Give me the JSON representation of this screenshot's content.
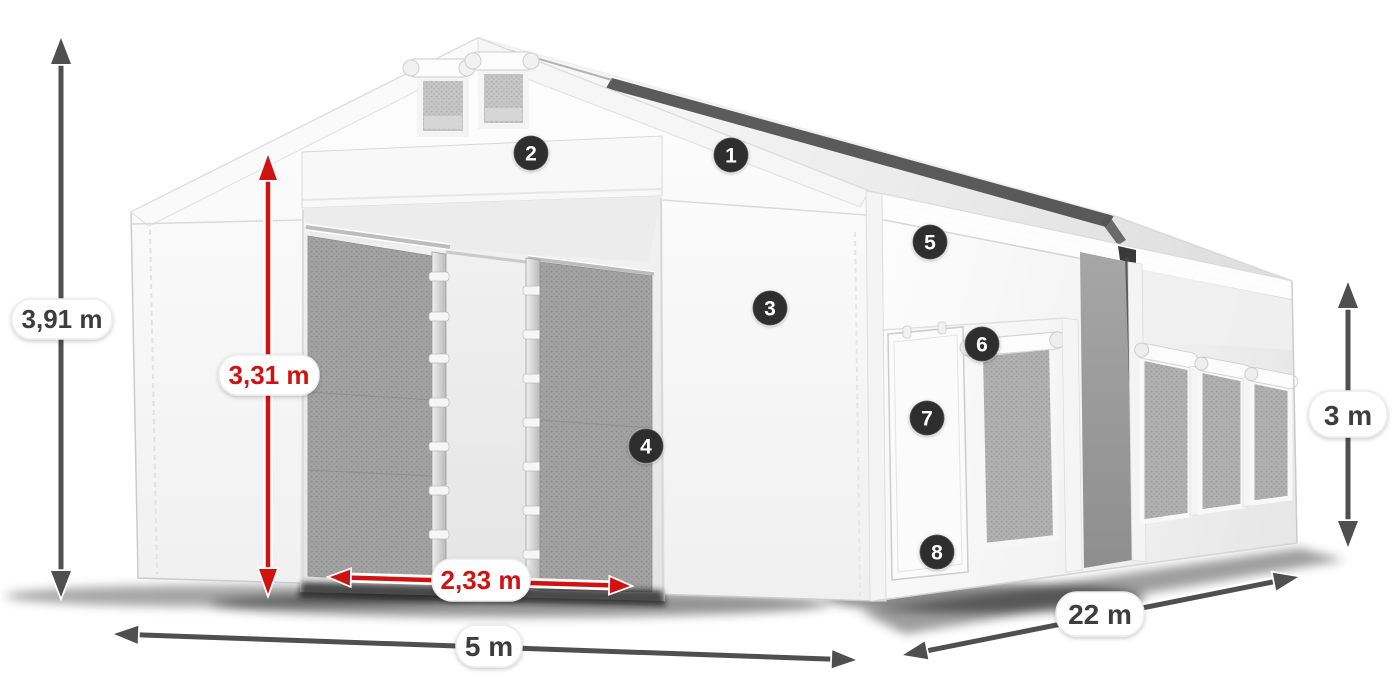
{
  "diagram": {
    "type": "product-dimension-diagram",
    "subject": "White storage tent (marquee) 3D render with dimension arrows and numbered feature callouts",
    "dimensions": [
      {
        "id": "total_height",
        "label": "3,91 m",
        "color": "gray"
      },
      {
        "id": "entrance_height",
        "label": "3,31 m",
        "color": "red"
      },
      {
        "id": "entrance_width",
        "label": "2,33 m",
        "color": "red"
      },
      {
        "id": "front_width",
        "label": "5 m",
        "color": "gray"
      },
      {
        "id": "side_length",
        "label": "22 m",
        "color": "gray"
      },
      {
        "id": "side_wall_height",
        "label": "3 m",
        "color": "gray"
      }
    ],
    "callouts": [
      {
        "number": "1"
      },
      {
        "number": "2"
      },
      {
        "number": "3"
      },
      {
        "number": "4"
      },
      {
        "number": "5"
      },
      {
        "number": "6"
      },
      {
        "number": "7"
      },
      {
        "number": "8"
      }
    ],
    "colors": {
      "dimension_red": "#cf1212",
      "dimension_gray": "#4f4f4f",
      "badge_background": "#2e2e2e",
      "badge_text": "#ffffff",
      "label_background": "#ffffff",
      "label_text_gray": "#3d3d3d",
      "canvas_background": "#ffffff"
    }
  }
}
